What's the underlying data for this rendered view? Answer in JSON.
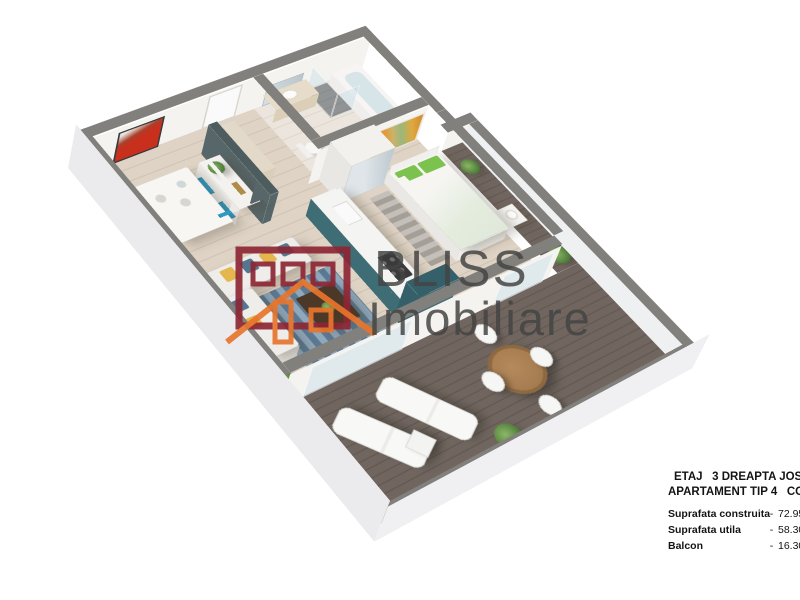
{
  "watermark": {
    "brand_line1": "BLISS",
    "brand_line2": "Imobiliare",
    "logo": {
      "building_color": "#8e2635",
      "house_color": "#e8752c"
    }
  },
  "info_panel": {
    "title_line1": "ETAJ   3 DREAPTA JOS",
    "title_line2": "APARTAMENT TIP 4   CORP C",
    "separator": "-",
    "rows": [
      {
        "label": "Suprafata construita",
        "value": "72.95 m"
      },
      {
        "label": "Suprafata utila",
        "value": "58.30 m"
      },
      {
        "label": "Balcon",
        "value": "16.30 m"
      }
    ]
  },
  "scene": {
    "type": "3d-isometric-apartment-floor-plan-render",
    "rooms": [
      "living-room",
      "dining-area",
      "kitchen",
      "bedroom",
      "bathroom",
      "hallway",
      "terrace-balcony"
    ],
    "colors": {
      "wall_top": "#82807c",
      "wall_face": "#f5f3ef",
      "exterior_face": "#ebebee",
      "floor_wood": "#dcd0c1",
      "bathroom_floor": "#e8e1d8",
      "deck_light": "#70665f",
      "deck_dark": "#5f564f",
      "kitchen_teal": "#3f6d75",
      "kitchen_teal_dark": "#35606a",
      "chair_blue": "#2f9ac4",
      "rug_blue": "#6f8fa8",
      "pillow_yellow": "#e3b64e",
      "pillow_blue": "#54778f",
      "pillow_green": "#7cc24f",
      "art_red": "#c92f1d",
      "art_orange": "#e8972f",
      "plant_green": "#4e7c39",
      "wood_dark": "#4c3826",
      "table_wood": "#a57c50",
      "partition_dark": "#576668",
      "watermark_text": "#454545"
    }
  }
}
